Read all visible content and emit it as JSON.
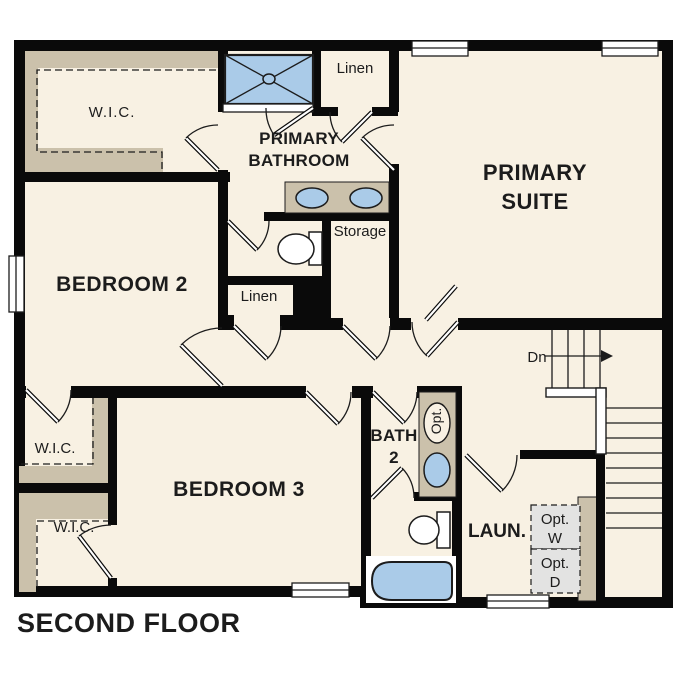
{
  "title": "SECOND FLOOR",
  "colors": {
    "paper": "#ffffff",
    "floor": "#f8f1e3",
    "wall": "#0a0a0a",
    "tan": "#cbc1ab",
    "blue": "#aacbe8",
    "gray": "#e3e3e2",
    "ink": "#1c1c1c"
  },
  "rooms": {
    "primary_suite": {
      "line1": "PRIMARY",
      "line2": "SUITE"
    },
    "primary_bathroom": {
      "line1": "PRIMARY",
      "line2": "BATHROOM"
    },
    "bedroom2": {
      "label": "BEDROOM 2"
    },
    "bedroom3": {
      "label": "BEDROOM 3"
    },
    "bath2": {
      "line1": "BATH",
      "line2": "2"
    },
    "laundry": {
      "label": "LAUN."
    },
    "wic_top_left": {
      "label": "W.I.C."
    },
    "wic_mid_left": {
      "label": "W.I.C."
    },
    "wic_bottom_left": {
      "label": "W.I.C."
    },
    "linen_top": {
      "label": "Linen"
    },
    "linen_hall": {
      "label": "Linen"
    },
    "storage": {
      "label": "Storage"
    }
  },
  "stairs": {
    "direction_label": "Dn"
  },
  "appliances": {
    "optional_washer": {
      "line1": "Opt.",
      "line2": "W"
    },
    "optional_dryer": {
      "line1": "Opt.",
      "line2": "D"
    },
    "optional_sink_label": "Opt."
  }
}
